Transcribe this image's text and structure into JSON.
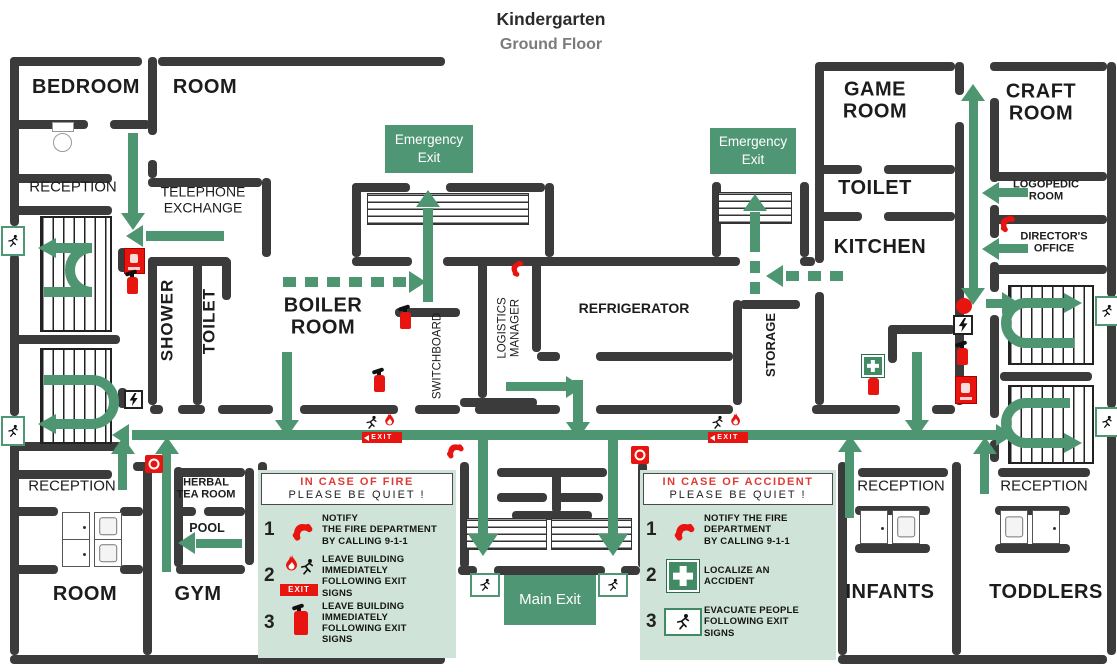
{
  "title": {
    "main": "Kindergarten",
    "subtitle": "Ground Floor"
  },
  "signs": {
    "emergency_exit_left": "Emergency\nExit",
    "emergency_exit_right": "Emergency\nExit",
    "main_exit": "Main Exit",
    "exit_tag": "EXIT"
  },
  "rooms": {
    "bedroom": "BEDROOM",
    "room_top_left": "ROOM",
    "reception_top_left": "RECEPTION",
    "telephone_exchange": "TELEPHONE\nEXCHANGE",
    "shower": "SHOWER",
    "toilet_left": "TOILET",
    "boiler_room": "BOILER\nROOM",
    "switchboard": "SWITCHBOARD",
    "logistics_manager": "LOGISTICS\nMANAGER",
    "refrigerator": "REFRIGERATOR",
    "storage": "STORAGE",
    "game_room": "GAME\nROOM",
    "craft_room": "CRAFT\nROOM",
    "toilet_right": "TOILET",
    "kitchen": "KITCHEN",
    "logopedic_room": "LOGOPEDIC\nROOM",
    "directors_office": "DIRECTOR'S\nOFFICE",
    "reception_bottom_left": "RECEPTION",
    "herbal_tea_room": "HERBAL\nTEA ROOM",
    "pool": "POOL",
    "room_bottom_left": "ROOM",
    "gym": "GYM",
    "reception_infants": "RECEPTION",
    "reception_toddlers": "RECEPTION",
    "infants": "INFANTS",
    "toddlers": "TODDLERS"
  },
  "panels": {
    "fire": {
      "title": "IN CASE OF FIRE",
      "subtitle": "PLEASE BE QUIET !",
      "steps": [
        {
          "num": "1",
          "icon": "phone-icon",
          "text": "NOTIFY\nTHE FIRE DEPARTMENT\nBY CALLING 9-1-1"
        },
        {
          "num": "2",
          "icon": "exit-flame-icon",
          "text": "LEAVE BUILDING\nIMMEDIATELY\nFOLLOWING EXIT\nSIGNS"
        },
        {
          "num": "3",
          "icon": "fire-extinguisher-icon",
          "text": "LEAVE BUILDING\nIMMEDIATELY\nFOLLOWING EXIT\nSIGNS"
        }
      ]
    },
    "accident": {
      "title": "IN CASE OF ACCIDENT",
      "subtitle": "PLEASE BE QUIET !",
      "steps": [
        {
          "num": "1",
          "icon": "phone-icon",
          "text": "NOTIFY THE FIRE\nDEPARTMENT\nBY CALLING 9-1-1"
        },
        {
          "num": "2",
          "icon": "first-aid-icon",
          "text": "LOCALIZE AN\nACCIDENT"
        },
        {
          "num": "3",
          "icon": "exit-man-icon",
          "text": "EVACUATE PEOPLE\nFOLLOWING EXIT\nSIGNS"
        }
      ]
    }
  },
  "colors": {
    "route_green": "#4e9571",
    "sign_green": "#4f9774",
    "wall_dark": "#3b3b3b",
    "alert_red": "#e8140f",
    "panel_bg": "#cfe3d8"
  }
}
